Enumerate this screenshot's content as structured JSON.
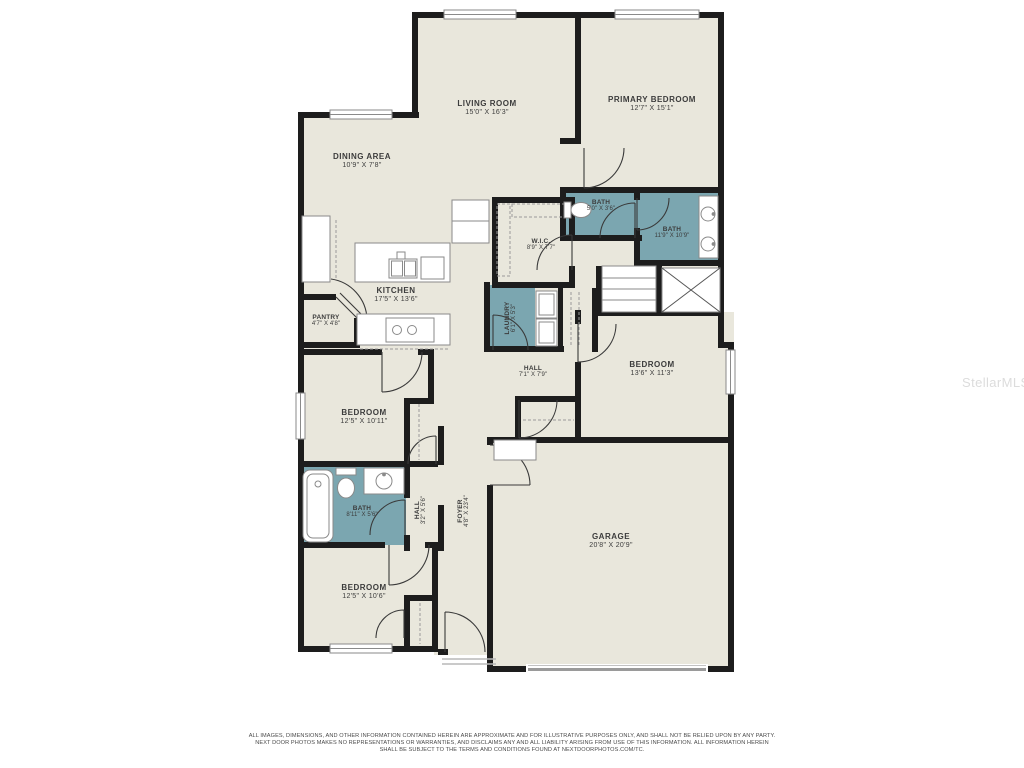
{
  "watermark": {
    "text": "StellarMLS"
  },
  "colors": {
    "wall": "#1d1d1d",
    "floor": "#e9e7dc",
    "wet_room": "#7ba6b0",
    "background": "#ffffff",
    "fixture_stroke": "#8a8a8a",
    "label_text": "#3c3c3c"
  },
  "rooms": {
    "living_room": {
      "name": "LIVING ROOM",
      "dims": "15'0\" X 16'3\""
    },
    "primary_bedroom": {
      "name": "PRIMARY BEDROOM",
      "dims": "12'7\" X 15'1\""
    },
    "dining_area": {
      "name": "DINING AREA",
      "dims": "10'9\" X 7'8\""
    },
    "bath_primary_wc": {
      "name": "BATH",
      "dims": "5'0\" X 3'6\""
    },
    "bath_primary": {
      "name": "BATH",
      "dims": "11'9\" X 10'9\""
    },
    "wic": {
      "name": "W.I.C.",
      "dims": "8'9\" X 7'7\""
    },
    "kitchen": {
      "name": "KITCHEN",
      "dims": "17'5\" X 13'6\""
    },
    "pantry": {
      "name": "PANTRY",
      "dims": "4'7\" X 4'8\""
    },
    "laundry": {
      "name": "LAUNDRY",
      "dims": "6'1\" X 5'3\""
    },
    "hall_center": {
      "name": "HALL",
      "dims": "7'1\" X 7'9\""
    },
    "bedroom_right": {
      "name": "BEDROOM",
      "dims": "13'6\" X 11'3\""
    },
    "bedroom_left": {
      "name": "BEDROOM",
      "dims": "12'5\" X 10'11\""
    },
    "bath_hall": {
      "name": "BATH",
      "dims": "8'11\" X 5'6\""
    },
    "hall_small": {
      "name": "HALL",
      "dims": "3'2\" X 5'6\""
    },
    "foyer": {
      "name": "FOYER",
      "dims": "4'8\" X 23'4\""
    },
    "garage": {
      "name": "GARAGE",
      "dims": "20'8\" X 20'9\""
    },
    "bedroom_bottom": {
      "name": "BEDROOM",
      "dims": "12'5\" X 10'6\""
    }
  },
  "disclaimer": {
    "line1": "ALL IMAGES, DIMENSIONS, AND OTHER INFORMATION CONTAINED HEREIN ARE APPROXIMATE AND FOR ILLUSTRATIVE PURPOSES ONLY, AND SHALL NOT BE RELIED UPON BY ANY PARTY.",
    "line2": "NEXT DOOR PHOTOS MAKES NO REPRESENTATIONS OR WARRANTIES, AND DISCLAIMS ANY AND ALL LIABILITY ARISING FROM USE OF THIS INFORMATION. ALL INFORMATION HEREIN",
    "line3": "SHALL BE SUBJECT TO THE TERMS AND CONDITIONS FOUND AT NEXTDOORPHOTOS.COM/TC."
  }
}
